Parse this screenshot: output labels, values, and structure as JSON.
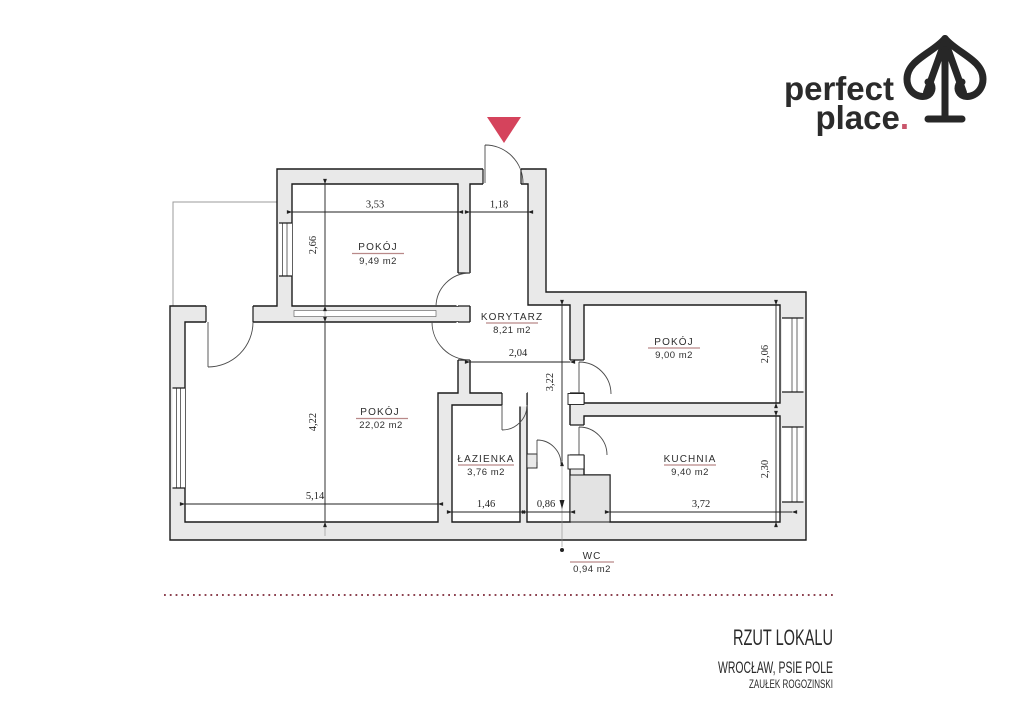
{
  "logo": {
    "line1": "perfect",
    "line2": "place",
    "dot": ".",
    "accent_color": "#c9556b",
    "icon": "spade-pin-arrow-icon"
  },
  "entrance": {
    "marker_color": "#d5435c",
    "marker": "entrance-triangle"
  },
  "rooms": [
    {
      "id": "pokoj-949",
      "name": "POKÓJ",
      "area": "9,49 m2"
    },
    {
      "id": "korytarz",
      "name": "KORYTARZ",
      "area": "8,21 m2"
    },
    {
      "id": "pokoj-900",
      "name": "POKÓJ",
      "area": "9,00 m2"
    },
    {
      "id": "pokoj-2202",
      "name": "POKÓJ",
      "area": "22,02 m2"
    },
    {
      "id": "lazienka",
      "name": "ŁAZIENKA",
      "area": "3,76 m2"
    },
    {
      "id": "kuchnia",
      "name": "KUCHNIA",
      "area": "9,40 m2"
    },
    {
      "id": "wc",
      "name": "WC",
      "area": "0,94 m2"
    }
  ],
  "dimensions": {
    "top_room_width": "3,53",
    "entry_width": "1,18",
    "top_room_height": "2,66",
    "korytarz_width": "2,04",
    "korytarz_height": "3,22",
    "room900_height": "2,06",
    "big_room_height": "4,22",
    "big_room_width": "5,14",
    "bathroom_width": "1,46",
    "wc_width": "0,86",
    "kitchen_width": "3,72",
    "kitchen_height": "2,30"
  },
  "footer": {
    "title": "RZUT LOKALU",
    "location": "WROCŁAW, PSIE POLE",
    "street": "ZAUŁEK ROGOZINSKI"
  },
  "colors": {
    "wall_fill": "#e9e9e9",
    "outline": "#1c1c1c",
    "label_underline": "#b98989",
    "dotted_separator": "#8d4351",
    "accent_red": "#d5435c"
  }
}
